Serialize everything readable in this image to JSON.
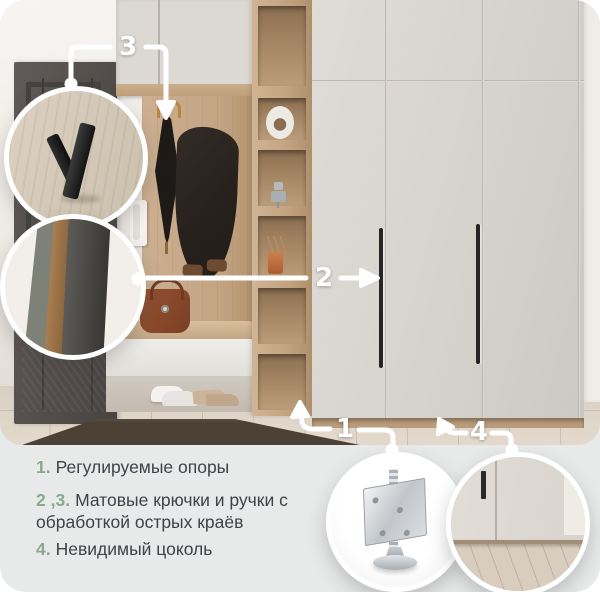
{
  "callouts": {
    "n1": "1",
    "n2": "2",
    "n3": "3",
    "n4": "4"
  },
  "legend": {
    "items": [
      {
        "num": "1.",
        "text": "Регулируемые опоры"
      },
      {
        "num": "2 ,3.",
        "text": "Матовые крючки и ручки с обработкой острых краёв"
      },
      {
        "num": "4.",
        "text": "Невидимый цоколь"
      }
    ]
  },
  "colors": {
    "card_bg": "#e8eae9",
    "accent_green": "#87a98c",
    "callout_white": "#ffffff",
    "text": "#3e4347"
  }
}
